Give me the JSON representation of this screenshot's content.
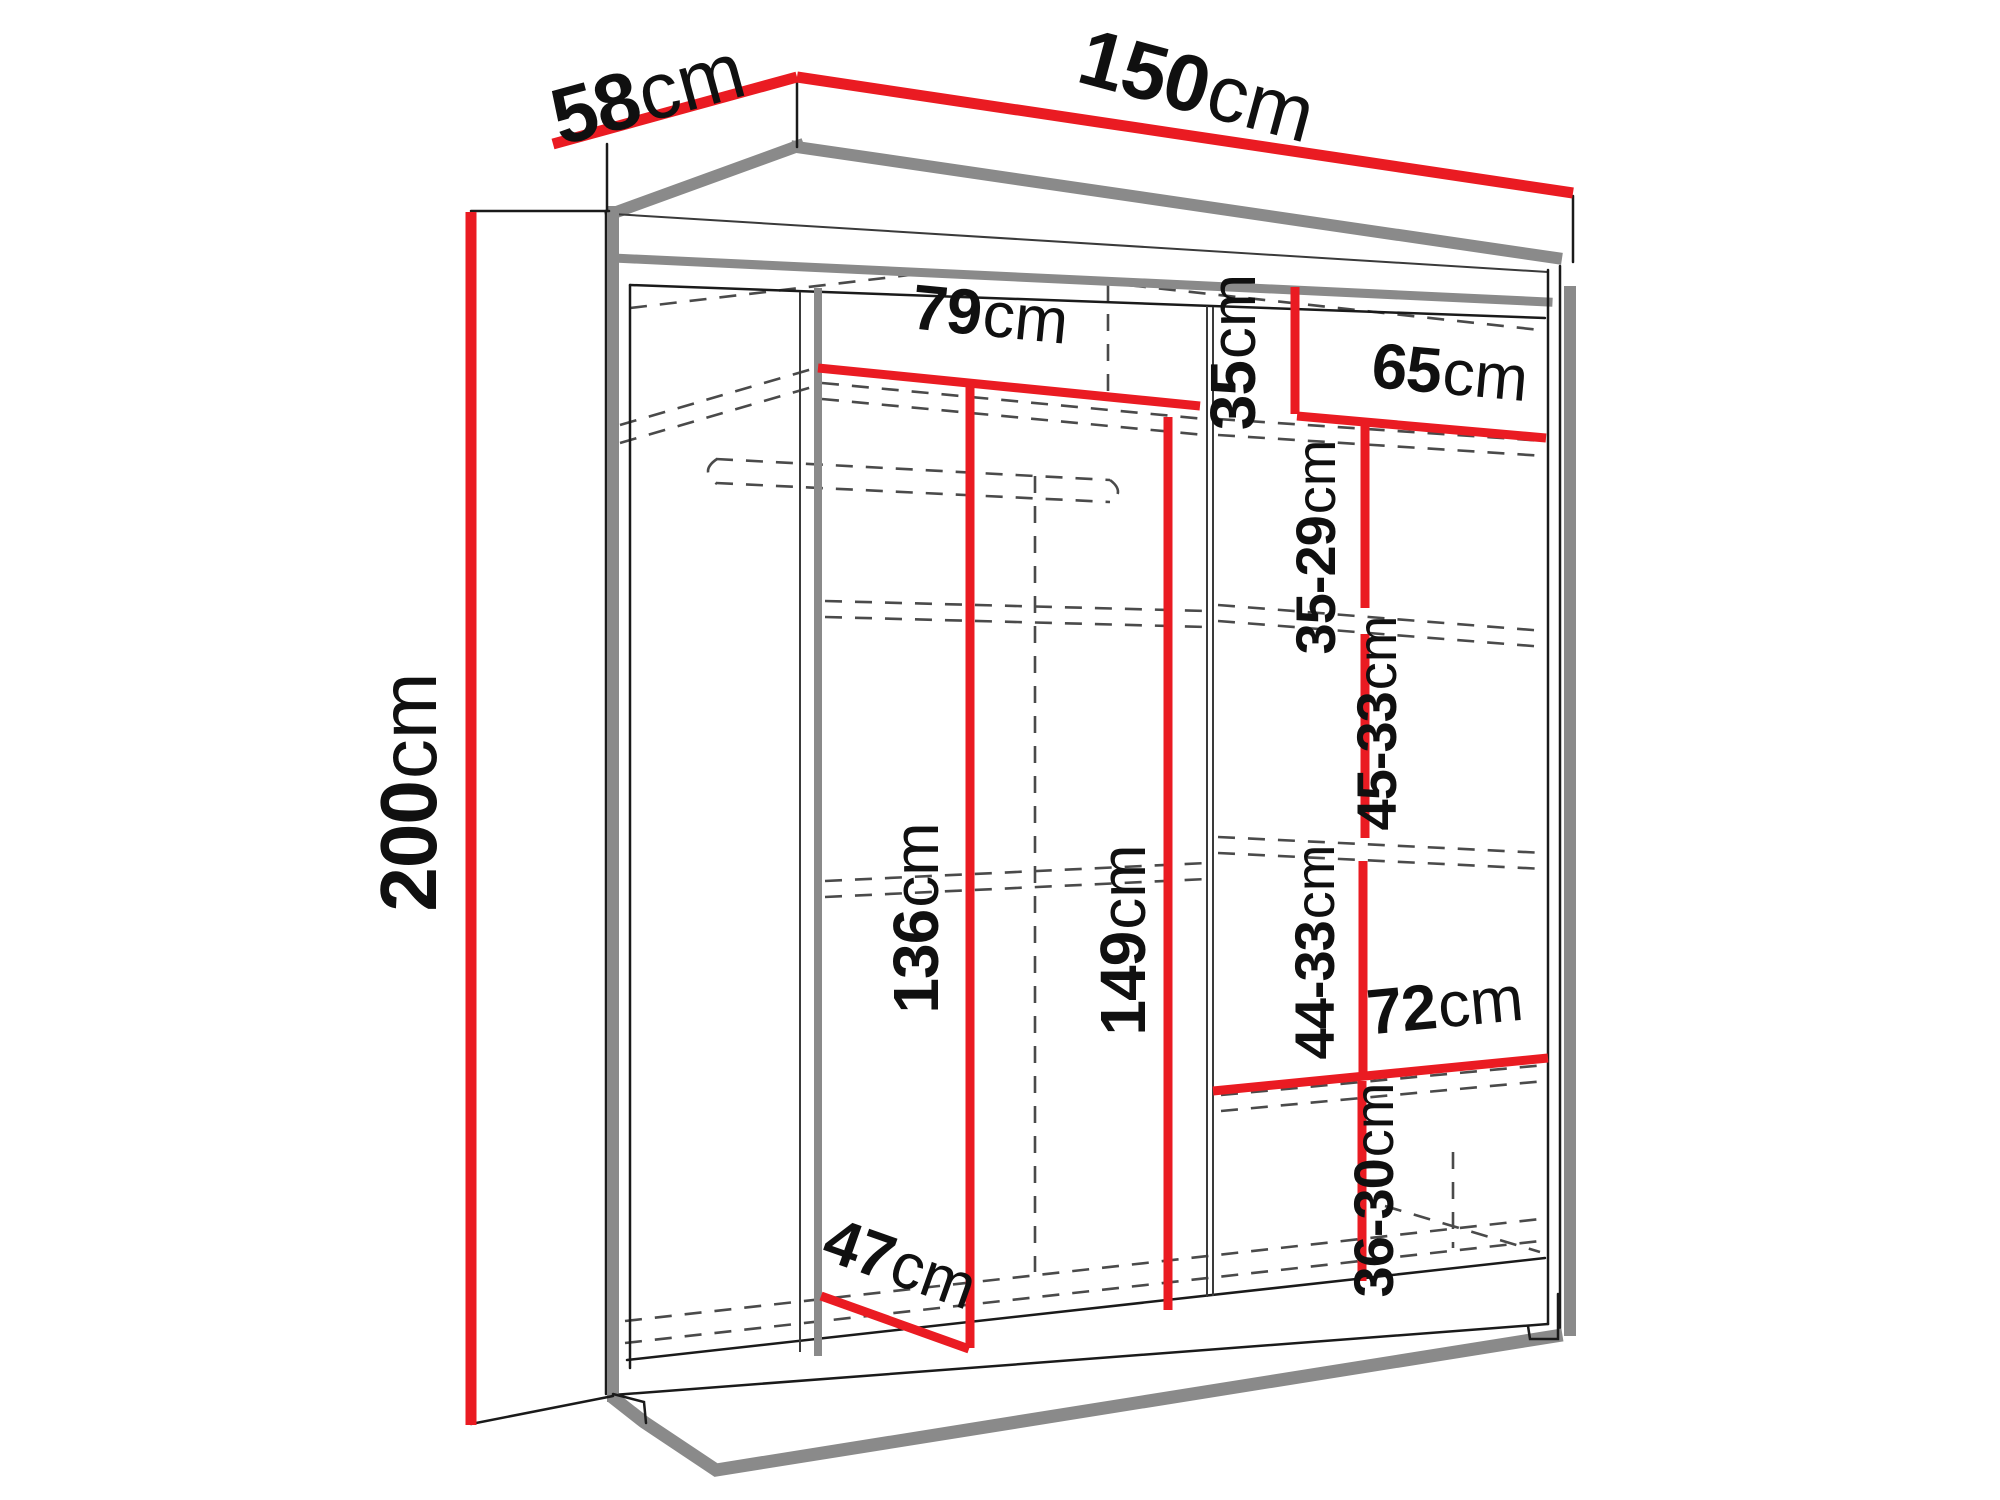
{
  "diagram": {
    "subject": "wardrobe-dimension-diagram",
    "unit_default": "cm",
    "colors": {
      "dimension_line": "#ea1b22",
      "outline": "#1a1a1a",
      "edge_shadow": "#8a8a8a",
      "hidden_edge": "#4a4a4a",
      "background": "#ffffff",
      "label_text": "#101010"
    },
    "dimensions": [
      {
        "id": "depth-top",
        "value": "58",
        "unit": "cm"
      },
      {
        "id": "width-top",
        "value": "150",
        "unit": "cm"
      },
      {
        "id": "height-left",
        "value": "200",
        "unit": "cm"
      },
      {
        "id": "left-section-width",
        "value": "79",
        "unit": "cm"
      },
      {
        "id": "top-right-gap",
        "value": "35",
        "unit": "cm"
      },
      {
        "id": "right-section-width",
        "value": "65",
        "unit": "cm"
      },
      {
        "id": "shelf-gap-1",
        "value": "35-29",
        "unit": "cm"
      },
      {
        "id": "shelf-gap-2",
        "value": "45-33",
        "unit": "cm"
      },
      {
        "id": "left-clear-height",
        "value": "136",
        "unit": "cm"
      },
      {
        "id": "center-clear-height",
        "value": "149",
        "unit": "cm"
      },
      {
        "id": "shelf-gap-3",
        "value": "44-33",
        "unit": "cm"
      },
      {
        "id": "bottom-shelf-width",
        "value": "72",
        "unit": "cm"
      },
      {
        "id": "shelf-gap-4",
        "value": "36-30",
        "unit": "cm"
      },
      {
        "id": "bottom-depth",
        "value": "47",
        "unit": "cm"
      }
    ]
  }
}
